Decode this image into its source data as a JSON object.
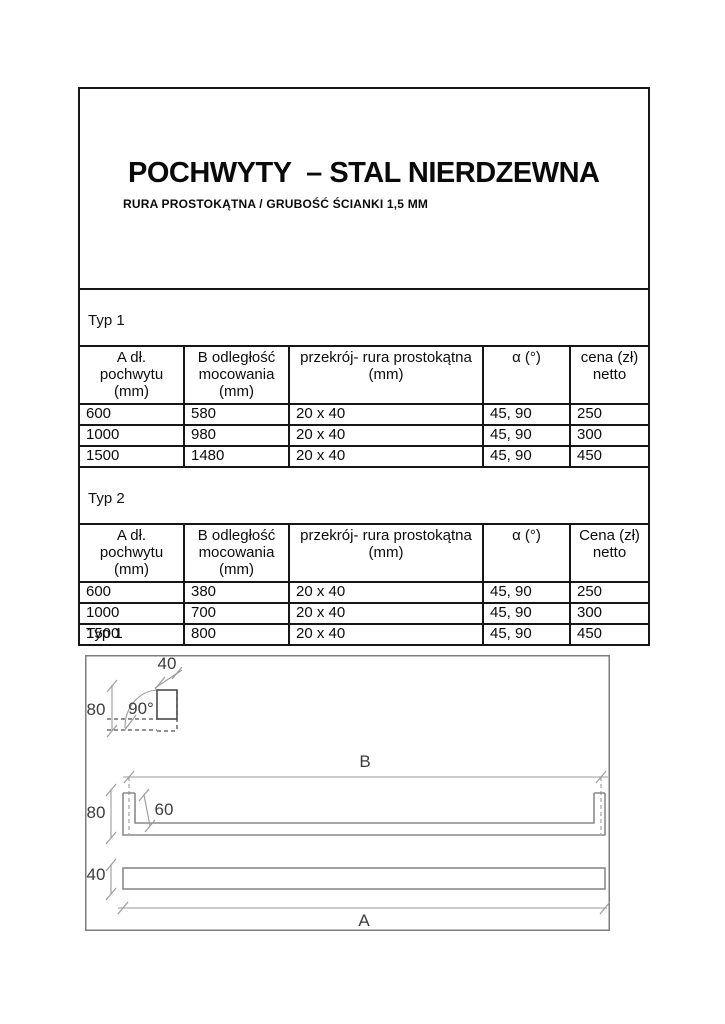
{
  "header": {
    "title": "POCHWYTY  – STAL NIERDZEWNA",
    "subtitle": "RURA PROSTOKĄTNA / GRUBOŚĆ ŚCIANKI 1,5 MM"
  },
  "tables": [
    {
      "label": "Typ 1",
      "columns": [
        "A dł.\npochwytu\n(mm)",
        "B odległość\nmocowania\n(mm)",
        "przekrój- rura prostokątna\n(mm)",
        "α (°)",
        "cena (zł)\nnetto"
      ],
      "rows": [
        [
          "600",
          "580",
          "20 x 40",
          "45, 90",
          "250"
        ],
        [
          "1000",
          "980",
          "20 x 40",
          "45, 90",
          "300"
        ],
        [
          "1500",
          "1480",
          "20 x 40",
          "45, 90",
          "450"
        ]
      ]
    },
    {
      "label": "Typ 2",
      "columns": [
        "A dł.\npochwytu\n(mm)",
        "B odległość\nmocowania\n(mm)",
        "przekrój- rura prostokątna\n(mm)",
        "α (°)",
        "Cena (zł)\nnetto"
      ],
      "rows": [
        [
          "600",
          "380",
          "20 x 40",
          "45, 90",
          "250"
        ],
        [
          "1000",
          "700",
          "20 x 40",
          "45, 90",
          "300"
        ],
        [
          "1500",
          "800",
          "20 x 40",
          "45, 90",
          "450"
        ]
      ]
    }
  ],
  "drawing": {
    "caption": "Typ 1",
    "labels": {
      "detail_width": "40",
      "detail_height": "80",
      "angle": "90°",
      "span": "B",
      "side_height": "80",
      "inner_height": "60",
      "bar_height": "40",
      "length": "A"
    }
  }
}
